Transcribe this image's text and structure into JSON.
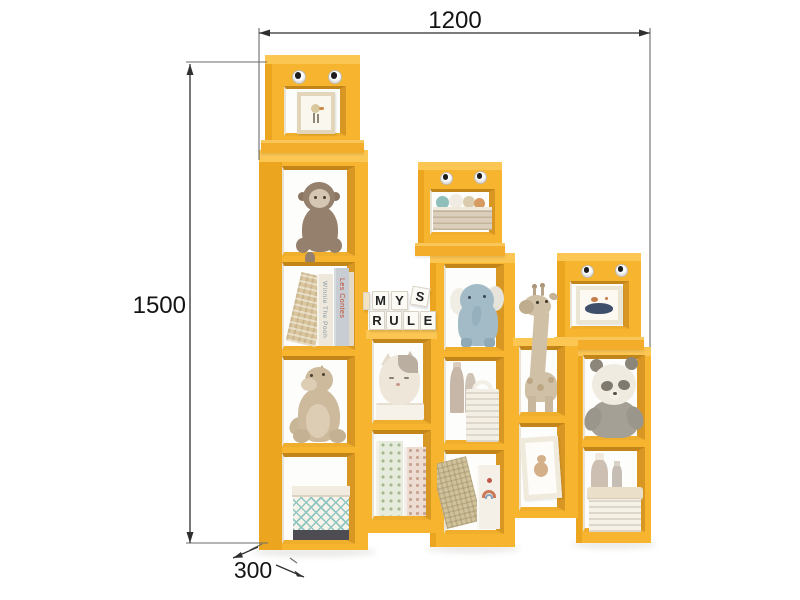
{
  "dimensions": {
    "width": "1200",
    "height": "1500",
    "depth": "300"
  },
  "letter_blocks": {
    "letters": [
      "M",
      "Y",
      "S",
      "R",
      "U",
      "L",
      "E"
    ],
    "word_top": "MY",
    "word_bottom": "RULE"
  },
  "book_spines": {
    "winnie": "Winnie The Pooh",
    "contes": "Les Contes"
  },
  "colors": {
    "shelf_yellow": "#F7B42F",
    "shelf_side": "#ECA51F",
    "shelf_top_face": "#FBC652",
    "shelf_inner_wall": "#D89722",
    "dimension_line": "#2F2F2F"
  },
  "shelf": {
    "style": "kids staircase cube bookshelf with robot faces",
    "towers": [
      {
        "name": "left-tall-tower",
        "head_item": "framed-bird-print",
        "compartments": [
          "monkey-plush",
          "story-books",
          "dino-plush",
          "checkered-storage-box"
        ]
      },
      {
        "name": "left-connector-column",
        "top_item": "letter-blocks",
        "compartments": [
          "cat-box-on-tray",
          "pattern-books"
        ]
      },
      {
        "name": "middle-tower",
        "head_item": "crate-of-balls",
        "compartments": [
          "elephant-plush",
          "bottles-and-basket",
          "craft-books"
        ]
      },
      {
        "name": "right-connector-column",
        "top_item": "giraffe-head",
        "compartments": [
          "giraffe-plush",
          "framed-teddy-print"
        ]
      },
      {
        "name": "right-short-tower",
        "head_item": "framed-whale-print",
        "compartments": [
          "panda-plush",
          "basket-and-bottles"
        ]
      }
    ]
  }
}
